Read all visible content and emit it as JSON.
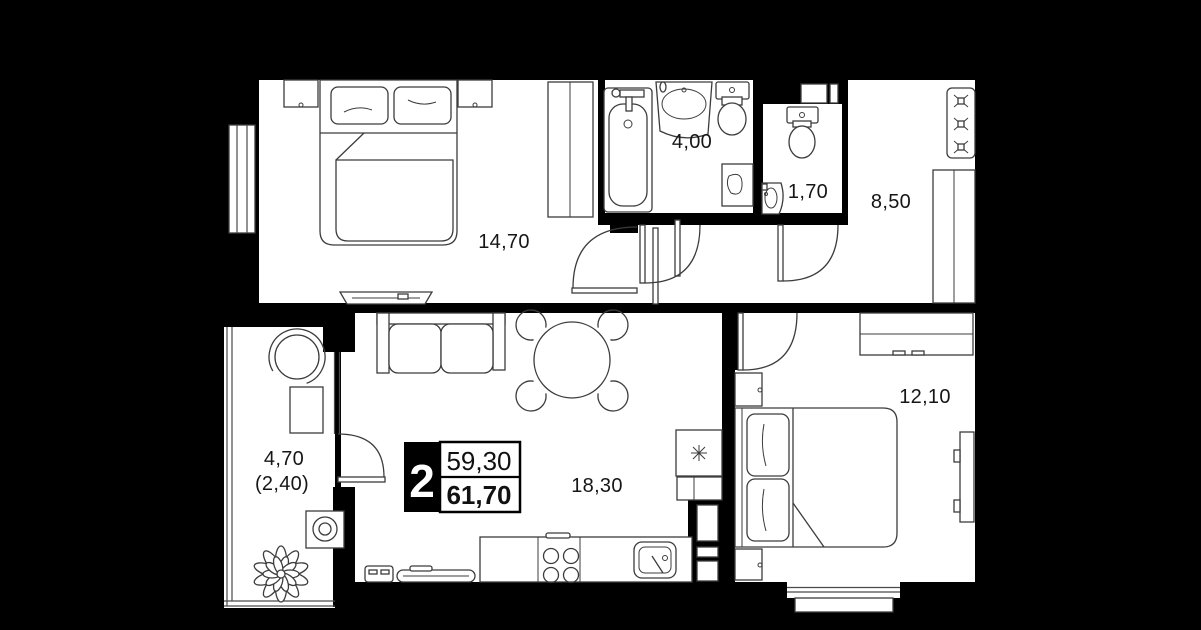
{
  "plan": {
    "type": "apartment-floor-plan",
    "badge": {
      "rooms": "2",
      "area_living": "59,30",
      "area_total": "61,70"
    },
    "rooms": [
      {
        "name": "bedroom-1",
        "area": "14,70"
      },
      {
        "name": "bathroom",
        "area": "4,00"
      },
      {
        "name": "wc",
        "area": "1,70"
      },
      {
        "name": "hallway",
        "area": "8,50"
      },
      {
        "name": "bedroom-2",
        "area": "12,10"
      },
      {
        "name": "kitchen-living",
        "area": "18,30"
      },
      {
        "name": "balcony",
        "area": "4,70",
        "area_note": "(2,40)"
      }
    ],
    "colors": {
      "background": "#000000",
      "walls": "#000000",
      "floor": "#ffffff",
      "furniture_line": "#3c3c3c",
      "label_text": "#161616",
      "badge_text": "#ffffff"
    }
  }
}
